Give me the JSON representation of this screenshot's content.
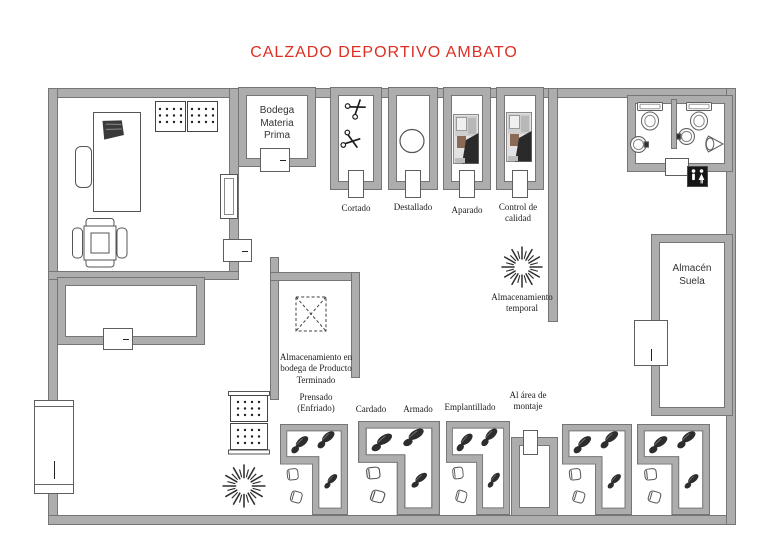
{
  "title": "CALZADO DEPORTIVO AMBATO",
  "rooms": {
    "bodega": "Bodega\nMateria\nPrima",
    "cortado": "Cortado",
    "destallado": "Destallado",
    "aparado": "Aparado",
    "control_calidad": "Control de\ncalidad",
    "almacen_suela": "Almacén\nSuela",
    "almacenamiento_temporal": "Almacenamiento\ntemporal",
    "almacenamiento_bodega": "Almacenamiento en\nbodega de Producto\nTerminado",
    "prensado": "Prensado\n(Enfriado)",
    "cardado": "Cardado",
    "armado": "Armado",
    "emplantillado": "Emplantillado",
    "al_area_montaje": "Al área de\nmontaje"
  },
  "colors": {
    "title_color": "#dd2f23",
    "wall_fill": "#adadad",
    "wall_edge": "#757575",
    "label_color": "#1c1c1c"
  },
  "icons": {
    "scissors_icon": "✂",
    "starburst_icon": "✳",
    "crate_icon": "⊠",
    "restroom_sign_icon": "🚻",
    "toilet_icon": "toilet-top-view",
    "sink_icon": "round-basin",
    "urinal_icon": "wall-urinal",
    "shoe_print_icon": "dark-shoe-sole",
    "stool_icon": "small-stool",
    "shelf_icon": "dotted-rack",
    "sewing_machine_photo": "grayscale-photo",
    "desk_icon": "desk-with-laptop",
    "chair_icon": "office-chair"
  }
}
